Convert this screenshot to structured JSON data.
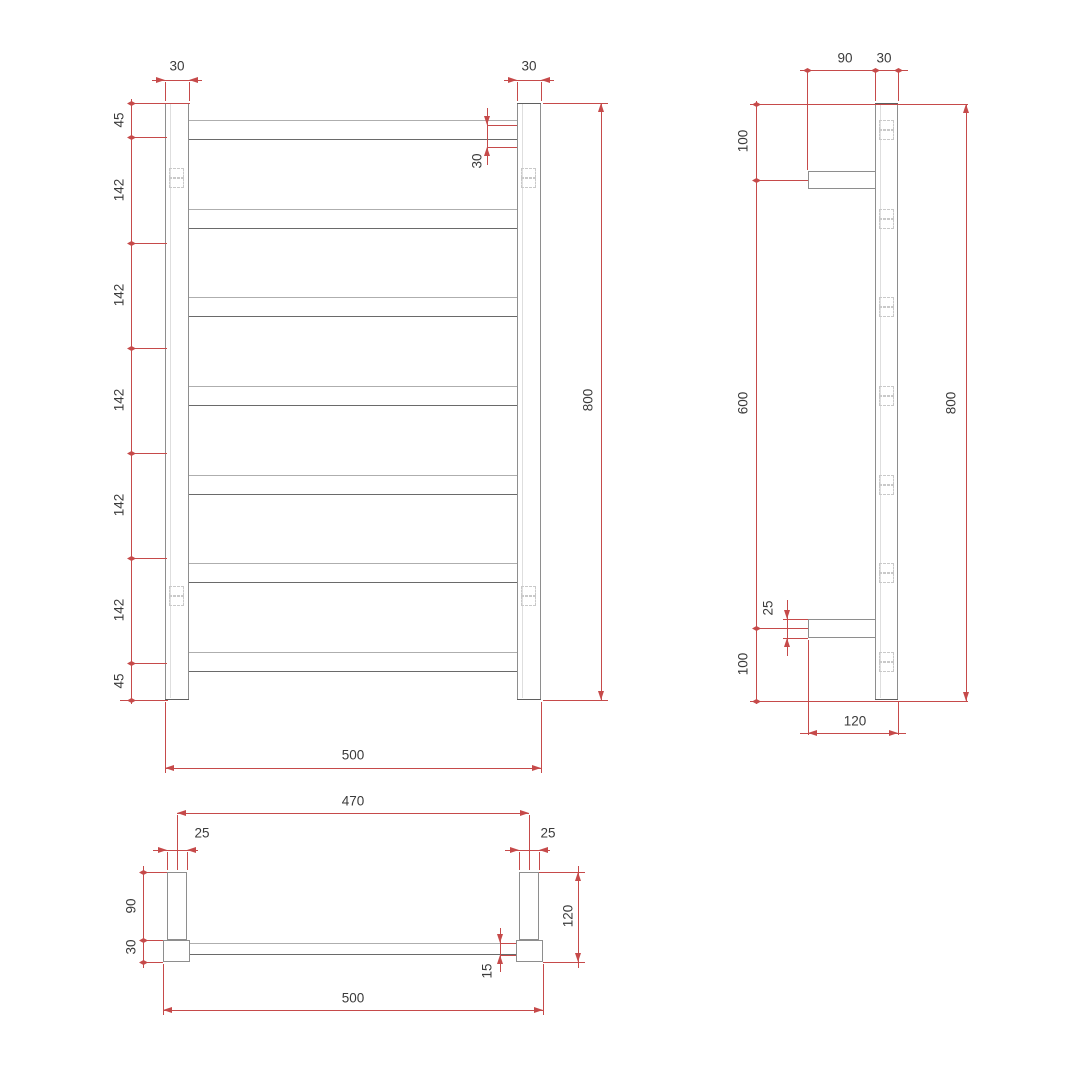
{
  "drawing": {
    "type": "heated-towel-rail-dimension-drawing",
    "colors": {
      "dimension_red": "#c64a4a",
      "line_grey": "#8e8e8e",
      "text": "#3b3b3b"
    }
  },
  "front": {
    "post_top_dims": [
      "30",
      "30"
    ],
    "bar_od": "30",
    "chain": [
      "45",
      "142",
      "142",
      "142",
      "142",
      "142",
      "45"
    ],
    "height": "800",
    "width": "500"
  },
  "side": {
    "top_dims": [
      "90",
      "30"
    ],
    "chain": [
      "100",
      "600",
      "100"
    ],
    "bracket_thickness": "25",
    "height": "800",
    "depth": "120"
  },
  "bottom": {
    "bracket_span": "470",
    "bracket_widths": [
      "25",
      "25"
    ],
    "arm_length": "90",
    "post_size": "30",
    "depth": "120",
    "bar_thickness": "15",
    "width": "500"
  }
}
